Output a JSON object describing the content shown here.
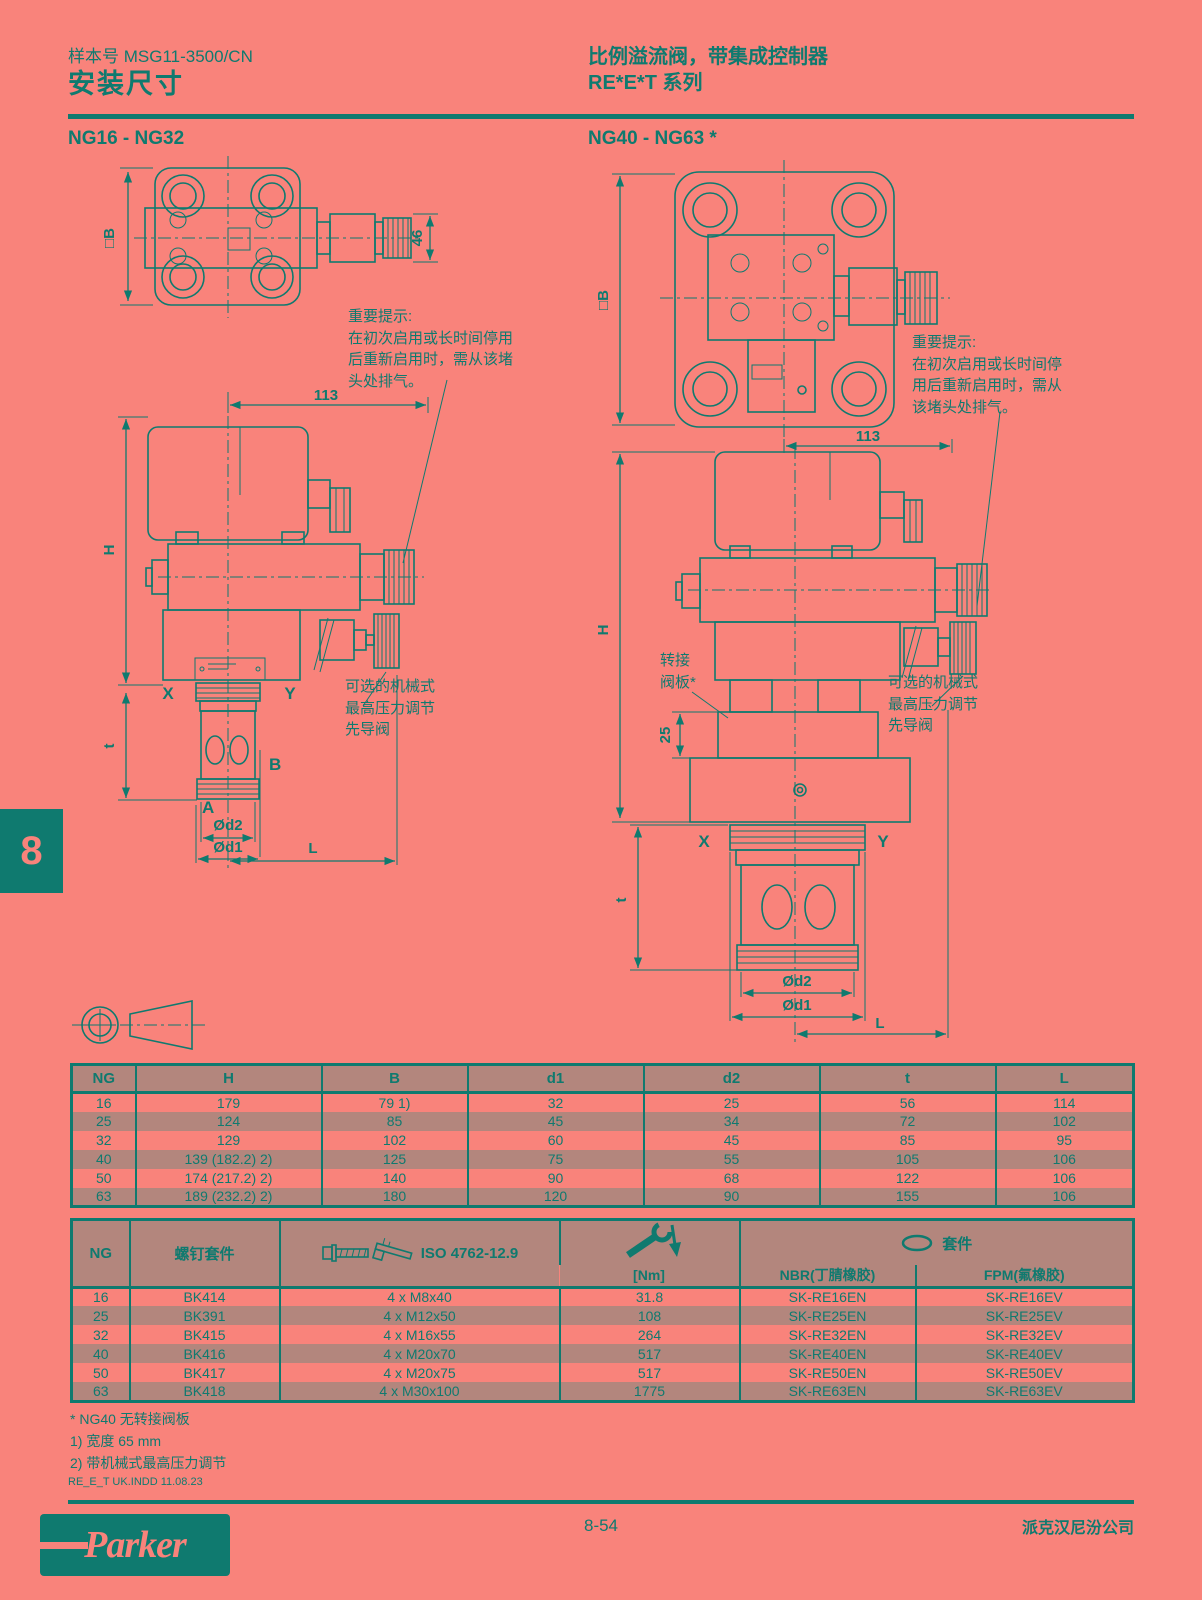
{
  "colors": {
    "background": "#f9837b",
    "ink": "#0f7a6f",
    "stripe": "#b3867d"
  },
  "header": {
    "catalog_no": "样本号 MSG11-3500/CN",
    "page_title": "安装尺寸",
    "product_title": "比例溢流阀，带集成控制器",
    "series_title": "RE*E*T 系列"
  },
  "sections": {
    "left": "NG16 - NG32",
    "right": "NG40 - NG63 *"
  },
  "chapter_tab": "8",
  "drawings": {
    "left": {
      "dims": {
        "b_square": "□B",
        "d46": "46",
        "d113": "113",
        "H": "H",
        "t": "t",
        "d2": "Ød2",
        "d1": "Ød1",
        "L": "L"
      },
      "ports": {
        "X": "X",
        "Y": "Y",
        "A": "A",
        "B": "B"
      },
      "important_note": [
        "重要提示:",
        "在初次启用或长时间停用",
        "后重新启用时，需从该堵",
        "头处排气。"
      ],
      "optional_note": [
        "可选的机械式",
        "最高压力调节",
        "先导阀"
      ]
    },
    "right": {
      "dims": {
        "b_square": "□B",
        "d113": "113",
        "H": "H",
        "d25": "25",
        "t": "t",
        "d2": "Ød2",
        "d1": "Ød1",
        "L": "L"
      },
      "ports": {
        "X": "X",
        "Y": "Y"
      },
      "adapter_label": [
        "转接",
        "阀板*"
      ],
      "important_note": [
        "重要提示:",
        "在初次启用或长时间停",
        "用后重新启用时，需从",
        "该堵头处排气。"
      ],
      "optional_note": [
        "可选的机械式",
        "最高压力调节",
        "先导阀"
      ]
    }
  },
  "dimension_table": {
    "headers": [
      "NG",
      "H",
      "B",
      "d1",
      "d2",
      "t",
      "L"
    ],
    "rows": [
      [
        "16",
        "179",
        "79 1)",
        "32",
        "25",
        "56",
        "114"
      ],
      [
        "25",
        "124",
        "85",
        "45",
        "34",
        "72",
        "102"
      ],
      [
        "32",
        "129",
        "102",
        "60",
        "45",
        "85",
        "95"
      ],
      [
        "40",
        "139 (182.2) 2)",
        "125",
        "75",
        "55",
        "105",
        "106"
      ],
      [
        "50",
        "174 (217.2) 2)",
        "140",
        "90",
        "68",
        "122",
        "106"
      ],
      [
        "63",
        "189 (232.2) 2)",
        "180",
        "120",
        "90",
        "155",
        "106"
      ]
    ]
  },
  "kit_table": {
    "headers": {
      "ng": "NG",
      "screw_kit": "螺钉套件",
      "iso": "ISO 4762-12.9",
      "torque": "[Nm]",
      "seal_kit": "套件",
      "nbr": "NBR(丁腈橡胶)",
      "fpm": "FPM(氟橡胶)"
    },
    "rows": [
      [
        "16",
        "BK414",
        "4 x M8x40",
        "31.8",
        "SK-RE16EN",
        "SK-RE16EV"
      ],
      [
        "25",
        "BK391",
        "4 x M12x50",
        "108",
        "SK-RE25EN",
        "SK-RE25EV"
      ],
      [
        "32",
        "BK415",
        "4 x M16x55",
        "264",
        "SK-RE32EN",
        "SK-RE32EV"
      ],
      [
        "40",
        "BK416",
        "4 x M20x70",
        "517",
        "SK-RE40EN",
        "SK-RE40EV"
      ],
      [
        "50",
        "BK417",
        "4 x M20x75",
        "517",
        "SK-RE50EN",
        "SK-RE50EV"
      ],
      [
        "63",
        "BK418",
        "4 x M30x100",
        "1775",
        "SK-RE63EN",
        "SK-RE63EV"
      ]
    ]
  },
  "footnotes": [
    "* NG40 无转接阀板",
    "1) 宽度 65 mm",
    "2) 带机械式最高压力调节"
  ],
  "footer": {
    "file_ref": "RE_E_T UK.INDD 11.08.23",
    "page_number": "8-54",
    "company": "派克汉尼汾公司",
    "logo_text": "Parker"
  }
}
